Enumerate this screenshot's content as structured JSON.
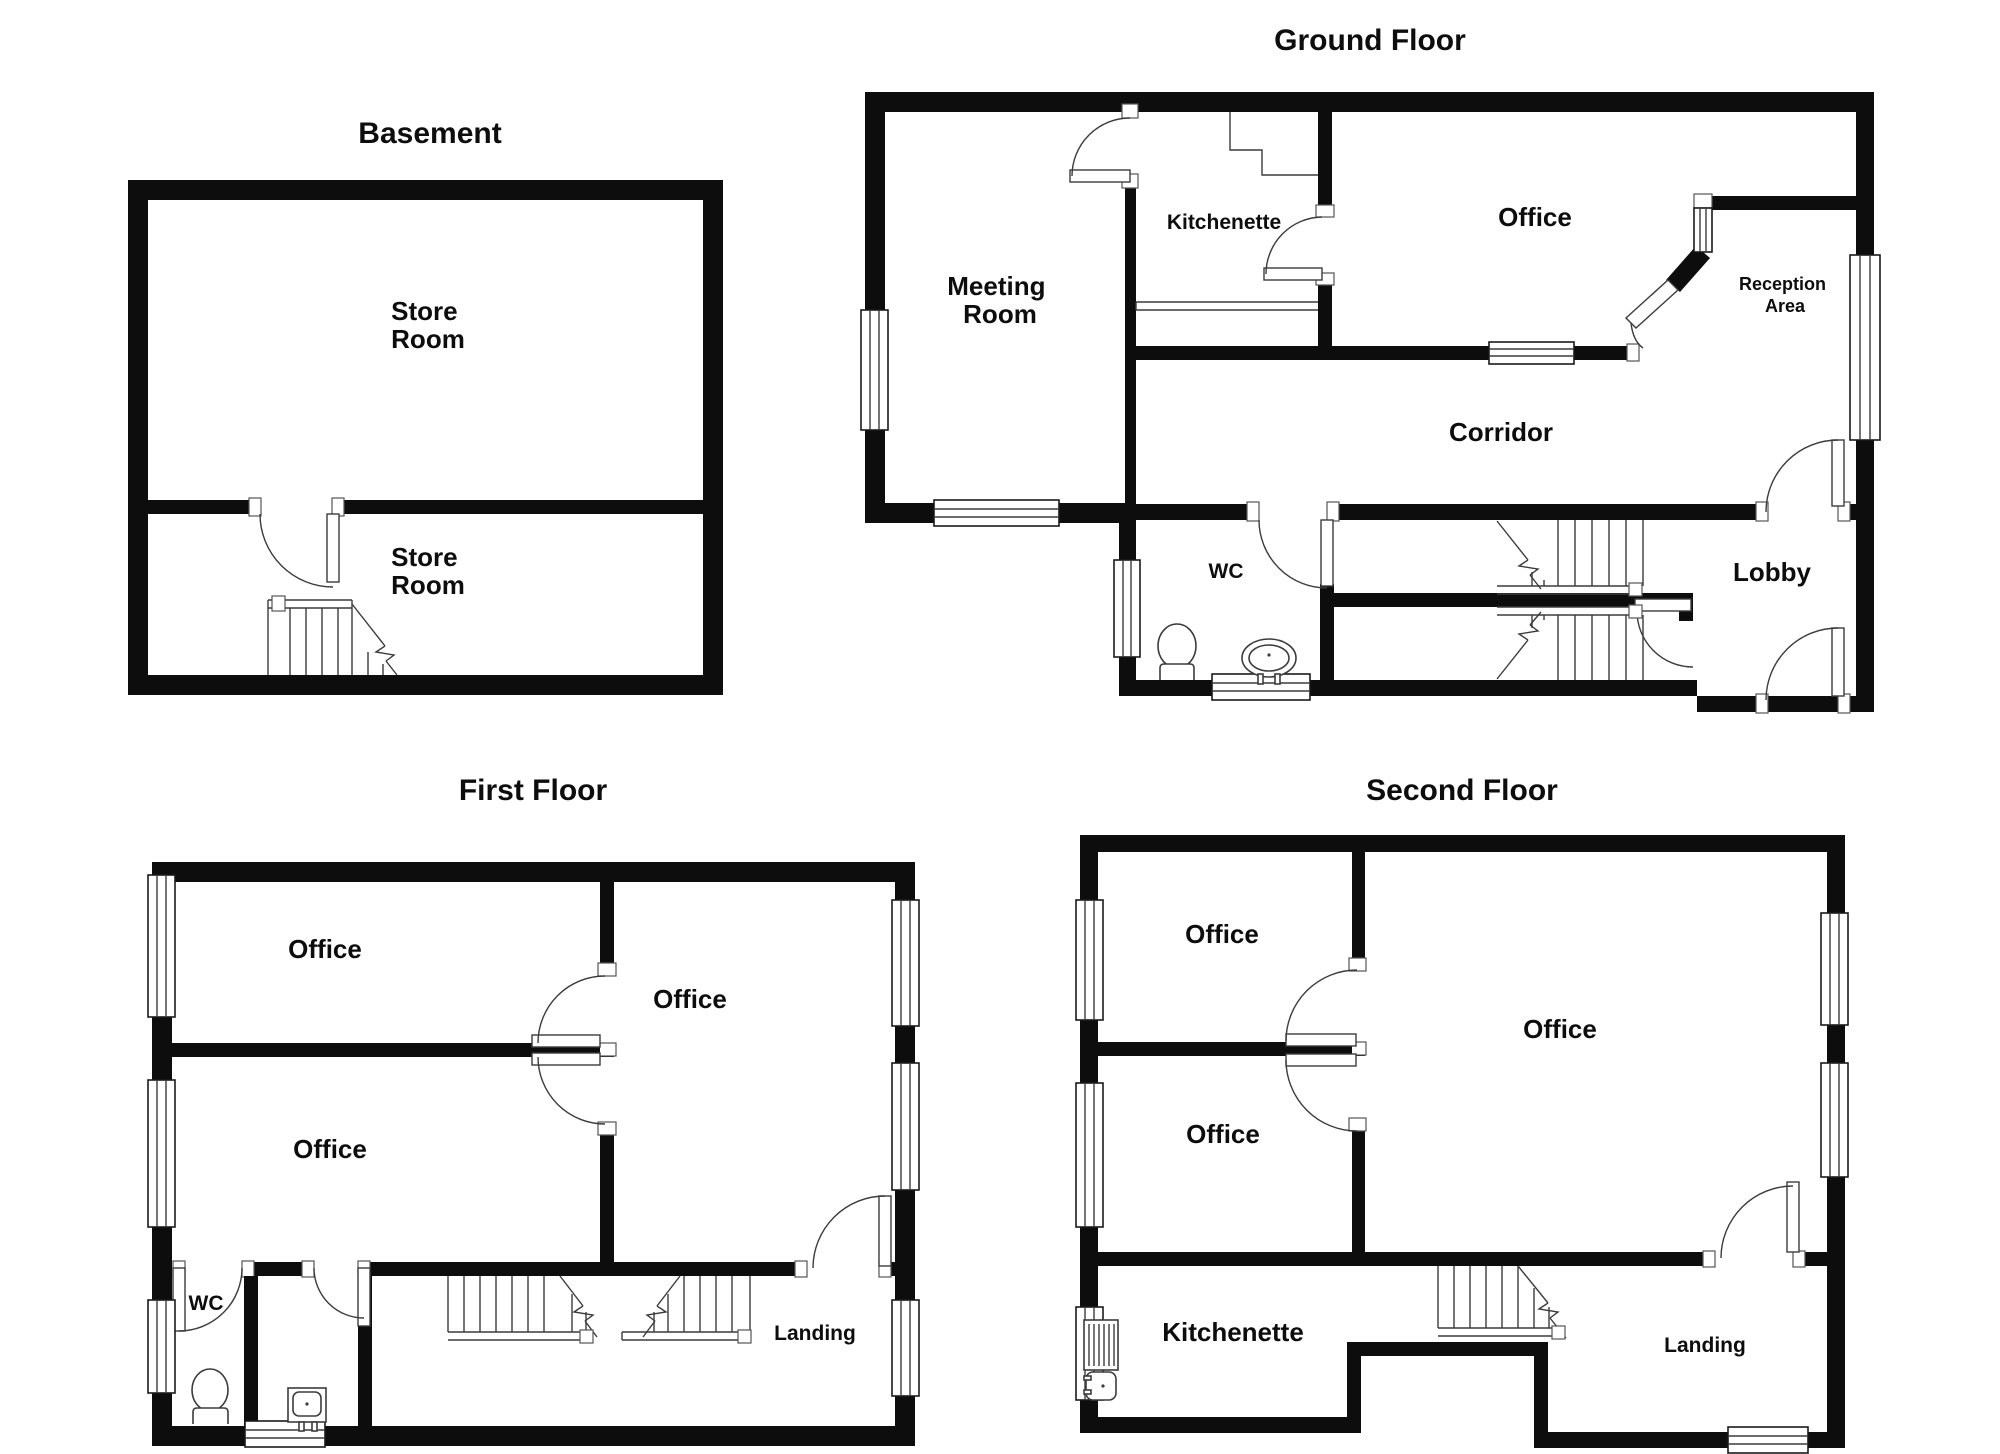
{
  "document": {
    "type": "floor-plan-sheet",
    "background_color": "#ffffff",
    "wall_color": "#0d0d0d",
    "line_color": "#3c3c3c"
  },
  "floors": [
    {
      "id": "basement",
      "title": "Basement",
      "rooms": [
        {
          "name": "store-room-upper",
          "lines": [
            "Store",
            "Room"
          ]
        },
        {
          "name": "store-room-lower",
          "lines": [
            "Store",
            "Room"
          ]
        }
      ],
      "features": [
        "staircase",
        "door"
      ]
    },
    {
      "id": "ground-floor",
      "title": "Ground Floor",
      "rooms": [
        {
          "name": "meeting-room",
          "lines": [
            "Meeting",
            "Room"
          ]
        },
        {
          "name": "kitchenette",
          "lines": [
            "Kitchenette"
          ]
        },
        {
          "name": "office",
          "lines": [
            "Office"
          ]
        },
        {
          "name": "reception-area",
          "lines": [
            "Reception",
            "Area"
          ]
        },
        {
          "name": "corridor",
          "lines": [
            "Corridor"
          ]
        },
        {
          "name": "wc",
          "lines": [
            "WC"
          ]
        },
        {
          "name": "lobby",
          "lines": [
            "Lobby"
          ]
        }
      ],
      "features": [
        "two-staircases",
        "toilet",
        "sink",
        "windows",
        "doors",
        "entrance-door"
      ]
    },
    {
      "id": "first-floor",
      "title": "First Floor",
      "rooms": [
        {
          "name": "office-top-left",
          "lines": [
            "Office"
          ]
        },
        {
          "name": "office-bottom-left",
          "lines": [
            "Office"
          ]
        },
        {
          "name": "office-large",
          "lines": [
            "Office"
          ]
        },
        {
          "name": "wc",
          "lines": [
            "WC"
          ]
        },
        {
          "name": "landing",
          "lines": [
            "Landing"
          ]
        }
      ],
      "features": [
        "two-staircases",
        "toilet",
        "sink",
        "windows",
        "doors"
      ]
    },
    {
      "id": "second-floor",
      "title": "Second Floor",
      "rooms": [
        {
          "name": "office-top-left",
          "lines": [
            "Office"
          ]
        },
        {
          "name": "office-bottom-left",
          "lines": [
            "Office"
          ]
        },
        {
          "name": "office-large",
          "lines": [
            "Office"
          ]
        },
        {
          "name": "kitchenette",
          "lines": [
            "Kitchenette"
          ]
        },
        {
          "name": "landing",
          "lines": [
            "Landing"
          ]
        }
      ],
      "features": [
        "staircase",
        "sink-with-drainer",
        "windows",
        "doors",
        "recess"
      ]
    }
  ]
}
